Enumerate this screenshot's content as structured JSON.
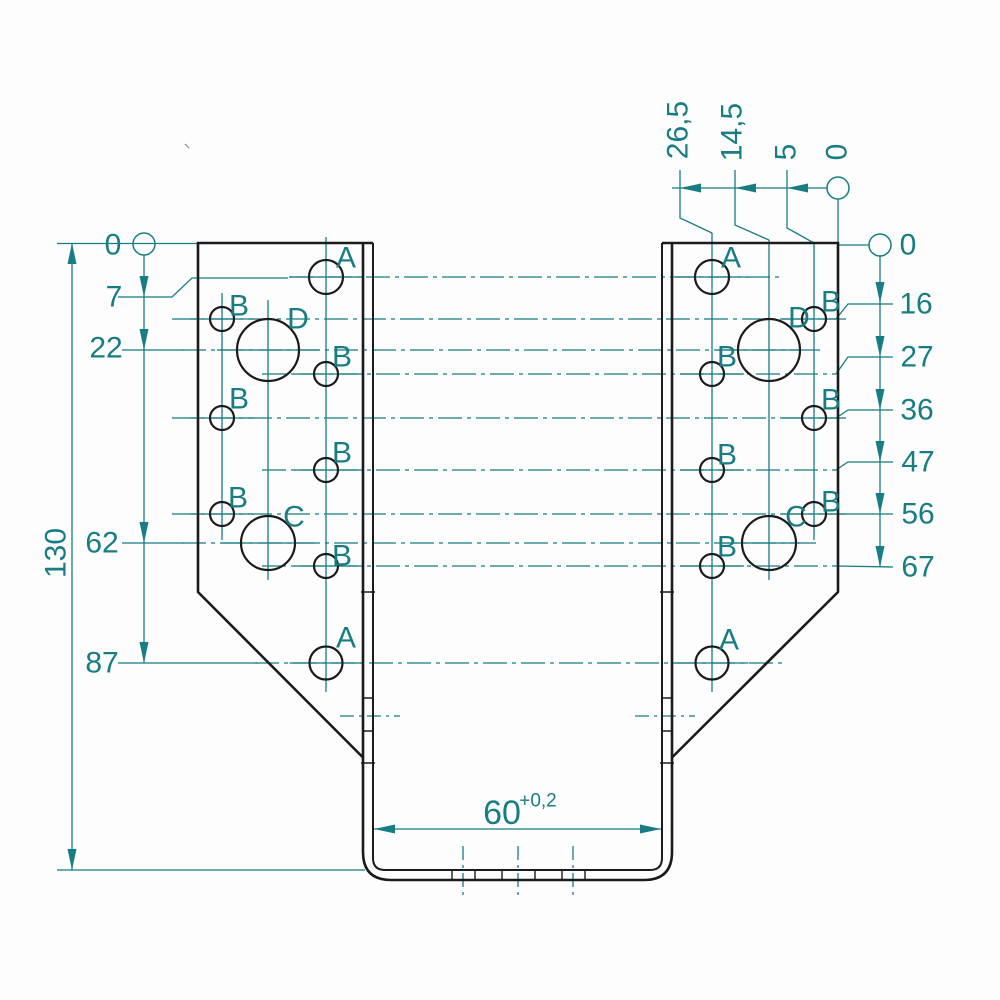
{
  "dimension_values": {
    "left_chain_mm": [
      "0",
      "7",
      "22",
      "62",
      "87"
    ],
    "overall_height_mm": "130",
    "right_chain_mm": [
      "0",
      "16",
      "27",
      "36",
      "47",
      "56",
      "67"
    ],
    "top_chain_mm": [
      "26,5",
      "14,5",
      "5",
      "0"
    ],
    "bottom_width_mm": "60",
    "bottom_width_tolerance": "+0,2",
    "hole_types": [
      "A",
      "B",
      "C",
      "D"
    ]
  },
  "drawing": {
    "colors": {
      "line": "#1b1b1b",
      "dim": "#177d83",
      "bg": "#fdfdfd"
    },
    "dashes": {
      "dd": "24,5,4,5",
      "dds": "14,5,3,5"
    },
    "black_paths": [
      {
        "name": "left-plate-outline",
        "d": "M 373,243 L 198,243 L 198,592 L 363.5,758",
        "w": 2.6
      },
      {
        "name": "right-plate-outline",
        "d": "M 662,243 L 838,243 L 838,592 L 671.5,758",
        "w": 2.6
      },
      {
        "name": "channel-outer-outline",
        "d": "M 363,243 L 363,852 Q 363,880 391,880 L 644,880 Q 672,880 672,852 L 672,243",
        "w": 2.6
      },
      {
        "name": "channel-inner-outline",
        "d": "M 373,243 L 373,858 Q 373,870 385,870 L 650,870 Q 662,870 662,858 L 662,243",
        "w": 2.0
      }
    ],
    "holes": [
      {
        "type": "A",
        "x": 326,
        "y": 277,
        "r": 17
      },
      {
        "type": "B",
        "x": 222,
        "y": 319,
        "r": 12
      },
      {
        "type": "D",
        "x": 268,
        "y": 350,
        "r": 31
      },
      {
        "type": "B",
        "x": 326,
        "y": 374,
        "r": 12
      },
      {
        "type": "B",
        "x": 222,
        "y": 418,
        "r": 12
      },
      {
        "type": "B",
        "x": 326,
        "y": 470,
        "r": 12
      },
      {
        "type": "B",
        "x": 222,
        "y": 514,
        "r": 12
      },
      {
        "type": "C",
        "x": 268,
        "y": 543,
        "r": 27
      },
      {
        "type": "B",
        "x": 326,
        "y": 566,
        "r": 12
      },
      {
        "type": "A",
        "x": 326,
        "y": 663,
        "r": 16.5
      },
      {
        "type": "A",
        "x": 712,
        "y": 277,
        "r": 17
      },
      {
        "type": "B",
        "x": 814,
        "y": 319,
        "r": 12
      },
      {
        "type": "D",
        "x": 769,
        "y": 350,
        "r": 31
      },
      {
        "type": "B",
        "x": 712,
        "y": 374,
        "r": 12
      },
      {
        "type": "B",
        "x": 814,
        "y": 418,
        "r": 12
      },
      {
        "type": "B",
        "x": 712,
        "y": 470,
        "r": 12
      },
      {
        "type": "B",
        "x": 814,
        "y": 514,
        "r": 12
      },
      {
        "type": "C",
        "x": 769,
        "y": 543,
        "r": 27
      },
      {
        "type": "B",
        "x": 712,
        "y": 566,
        "r": 12
      },
      {
        "type": "A",
        "x": 712,
        "y": 663,
        "r": 16.5
      }
    ],
    "black_ticks": [
      {
        "name": "fold-tick",
        "x1": 361,
        "y1": 592,
        "x2": 375,
        "y2": 592
      },
      {
        "name": "fold-tick",
        "x1": 660,
        "y1": 592,
        "x2": 674,
        "y2": 592
      },
      {
        "name": "fold-tick",
        "x1": 361,
        "y1": 763,
        "x2": 375,
        "y2": 763
      },
      {
        "name": "fold-tick",
        "x1": 660,
        "y1": 763,
        "x2": 674,
        "y2": 763
      },
      {
        "name": "fold-tick",
        "x1": 362,
        "y1": 698,
        "x2": 374,
        "y2": 698
      },
      {
        "name": "fold-tick",
        "x1": 661,
        "y1": 698,
        "x2": 673,
        "y2": 698
      },
      {
        "name": "fold-tick",
        "x1": 362,
        "y1": 731,
        "x2": 374,
        "y2": 731
      },
      {
        "name": "fold-tick",
        "x1": 661,
        "y1": 731,
        "x2": 673,
        "y2": 731
      },
      {
        "name": "slot-tick",
        "x1": 452,
        "y1": 870,
        "x2": 452,
        "y2": 880,
        "w": 1.4
      },
      {
        "name": "slot-tick",
        "x1": 475,
        "y1": 870,
        "x2": 475,
        "y2": 880,
        "w": 1.4
      },
      {
        "name": "slot-tick",
        "x1": 502,
        "y1": 870,
        "x2": 502,
        "y2": 880,
        "w": 1.4
      },
      {
        "name": "slot-tick",
        "x1": 535,
        "y1": 870,
        "x2": 535,
        "y2": 880,
        "w": 1.4
      },
      {
        "name": "slot-tick",
        "x1": 562,
        "y1": 870,
        "x2": 562,
        "y2": 880,
        "w": 1.4
      },
      {
        "name": "slot-tick",
        "x1": 585,
        "y1": 870,
        "x2": 585,
        "y2": 880,
        "w": 1.4
      },
      {
        "name": "paper-speck",
        "x1": 185,
        "y1": 144,
        "x2": 189,
        "y2": 148,
        "w": 1.2,
        "c": "#8a8a8a"
      }
    ],
    "teal_lines": [
      {
        "name": "ext-line-top-left",
        "x1": 57,
        "y1": 243.5,
        "x2": 198,
        "y2": 243.5
      },
      {
        "name": "ext-line-bottom-left",
        "x1": 57,
        "y1": 870,
        "x2": 365,
        "y2": 870
      },
      {
        "name": "dim-130-line",
        "x1": 72,
        "y1": 243,
        "x2": 72,
        "y2": 870
      },
      {
        "name": "dim-left-chain-line",
        "x1": 144,
        "y1": 255,
        "x2": 144,
        "y2": 663
      },
      {
        "name": "dim-right-chain-line",
        "x1": 880,
        "y1": 256,
        "x2": 880,
        "y2": 567
      },
      {
        "name": "dim-top-chain-line",
        "x1": 672,
        "y1": 188,
        "x2": 827,
        "y2": 188
      },
      {
        "name": "ext-line-right-0",
        "x1": 839,
        "y1": 245,
        "x2": 869,
        "y2": 245
      },
      {
        "name": "dim-60-line",
        "x1": 374,
        "y1": 829,
        "x2": 661,
        "y2": 829
      },
      {
        "name": "leader-22",
        "x1": 122,
        "y1": 350,
        "x2": 184,
        "y2": 350
      },
      {
        "name": "leader-62",
        "x1": 122,
        "y1": 543,
        "x2": 184,
        "y2": 543
      },
      {
        "name": "leader-87",
        "x1": 118,
        "y1": 663,
        "x2": 258,
        "y2": 663
      },
      {
        "name": "leader-56",
        "x1": 836,
        "y1": 514,
        "x2": 893,
        "y2": 514
      },
      {
        "name": "leader-67",
        "x1": 836,
        "y1": 566,
        "x2": 893,
        "y2": 567
      },
      {
        "name": "column-centerline",
        "x1": 222,
        "y1": 293,
        "x2": 222,
        "y2": 540
      },
      {
        "name": "column-centerline",
        "x1": 268,
        "y1": 300,
        "x2": 268,
        "y2": 580
      },
      {
        "name": "column-centerline",
        "x1": 326,
        "y1": 237,
        "x2": 326,
        "y2": 692
      },
      {
        "name": "column-centerline",
        "x1": 712,
        "y1": 233,
        "x2": 712,
        "y2": 692
      },
      {
        "name": "column-centerline",
        "x1": 769,
        "y1": 240,
        "x2": 769,
        "y2": 580
      },
      {
        "name": "column-centerline",
        "x1": 814,
        "y1": 243,
        "x2": 814,
        "y2": 540
      },
      {
        "name": "row-centerline",
        "x1": 290,
        "y1": 277,
        "x2": 783,
        "y2": 277,
        "dash": "dd"
      },
      {
        "name": "row-centerline",
        "x1": 172,
        "y1": 319,
        "x2": 836,
        "y2": 319,
        "dash": "dd"
      },
      {
        "name": "row-centerline",
        "x1": 182,
        "y1": 350,
        "x2": 800,
        "y2": 350,
        "dash": "dd"
      },
      {
        "name": "row-centerline",
        "x1": 262,
        "y1": 374,
        "x2": 836,
        "y2": 374,
        "dash": "dd"
      },
      {
        "name": "row-centerline",
        "x1": 172,
        "y1": 418,
        "x2": 836,
        "y2": 418,
        "dash": "dd"
      },
      {
        "name": "row-centerline",
        "x1": 262,
        "y1": 470,
        "x2": 836,
        "y2": 470,
        "dash": "dd"
      },
      {
        "name": "row-centerline",
        "x1": 172,
        "y1": 514,
        "x2": 836,
        "y2": 514,
        "dash": "dd"
      },
      {
        "name": "row-centerline",
        "x1": 182,
        "y1": 543,
        "x2": 800,
        "y2": 543,
        "dash": "dd"
      },
      {
        "name": "row-centerline",
        "x1": 262,
        "y1": 566,
        "x2": 836,
        "y2": 566,
        "dash": "dd"
      },
      {
        "name": "row-centerline",
        "x1": 255,
        "y1": 663,
        "x2": 783,
        "y2": 663,
        "dash": "dd"
      },
      {
        "name": "bend-centerline",
        "x1": 340,
        "y1": 716,
        "x2": 400,
        "y2": 716,
        "dash": "dds"
      },
      {
        "name": "bend-centerline",
        "x1": 635,
        "y1": 716,
        "x2": 695,
        "y2": 716,
        "dash": "dds"
      },
      {
        "name": "bottom-centerline",
        "x1": 463,
        "y1": 846,
        "x2": 463,
        "y2": 897,
        "dash": "dds"
      },
      {
        "name": "bottom-centerline",
        "x1": 518,
        "y1": 846,
        "x2": 518,
        "y2": 897,
        "dash": "dds"
      },
      {
        "name": "bottom-centerline",
        "x1": 573,
        "y1": 846,
        "x2": 573,
        "y2": 897,
        "dash": "dds"
      }
    ],
    "teal_polylines": [
      {
        "name": "leader-7",
        "pts": "118,297 172,297 192,278 288,278"
      },
      {
        "name": "leader-16",
        "pts": "836,319 848,304 893,304"
      },
      {
        "name": "leader-27",
        "pts": "836,374 848,357 893,357"
      },
      {
        "name": "leader-36",
        "pts": "836,418 848,410 893,410"
      },
      {
        "name": "leader-47",
        "pts": "836,470 848,462 893,462"
      },
      {
        "name": "leader-top-26-5",
        "pts": "680,170 680,218 712,233"
      },
      {
        "name": "leader-top-14-5",
        "pts": "735,170 735,225 769,240"
      },
      {
        "name": "leader-top-5",
        "pts": "787,170 787,228 814,243"
      },
      {
        "name": "leader-top-0",
        "pts": "838,199 838,243"
      }
    ],
    "datum_circles": [
      {
        "name": "datum-circle-left",
        "cx": 144,
        "cy": 244,
        "r": 11
      },
      {
        "name": "datum-circle-right",
        "cx": 880,
        "cy": 245,
        "r": 11
      },
      {
        "name": "datum-circle-top",
        "cx": 838,
        "cy": 188,
        "r": 11
      }
    ],
    "arrows": [
      {
        "name": "arrow-130-top",
        "dir": "up",
        "x": 72,
        "y": 243
      },
      {
        "name": "arrow-130-bottom",
        "dir": "down",
        "x": 72,
        "y": 870
      },
      {
        "name": "arrow-left-7",
        "dir": "down",
        "x": 144,
        "y": 297
      },
      {
        "name": "arrow-left-22",
        "dir": "down",
        "x": 144,
        "y": 350
      },
      {
        "name": "arrow-left-62",
        "dir": "down",
        "x": 144,
        "y": 543
      },
      {
        "name": "arrow-left-87",
        "dir": "down",
        "x": 144,
        "y": 663
      },
      {
        "name": "arrow-right-16",
        "dir": "down",
        "x": 880,
        "y": 303
      },
      {
        "name": "arrow-right-27",
        "dir": "down",
        "x": 880,
        "y": 357
      },
      {
        "name": "arrow-right-36",
        "dir": "down",
        "x": 880,
        "y": 410
      },
      {
        "name": "arrow-right-47",
        "dir": "down",
        "x": 880,
        "y": 462
      },
      {
        "name": "arrow-right-56",
        "dir": "down",
        "x": 880,
        "y": 514
      },
      {
        "name": "arrow-right-67",
        "dir": "down",
        "x": 880,
        "y": 567
      },
      {
        "name": "arrow-top-26-5",
        "dir": "left",
        "x": 680,
        "y": 188
      },
      {
        "name": "arrow-top-14-5",
        "dir": "left",
        "x": 735,
        "y": 188
      },
      {
        "name": "arrow-top-5",
        "dir": "left",
        "x": 787,
        "y": 188
      },
      {
        "name": "arrow-60-left",
        "dir": "left",
        "x": 374,
        "y": 829
      },
      {
        "name": "arrow-60-right",
        "dir": "right",
        "x": 661,
        "y": 829
      }
    ],
    "texts": [
      {
        "name": "dim-label-left-0",
        "text": "0",
        "x": 113,
        "y": 245
      },
      {
        "name": "dim-label-left-7",
        "text": "7",
        "x": 114,
        "y": 297
      },
      {
        "name": "dim-label-left-22",
        "text": "22",
        "x": 106,
        "y": 348
      },
      {
        "name": "dim-label-left-62",
        "text": "62",
        "x": 102,
        "y": 543
      },
      {
        "name": "dim-label-left-87",
        "text": "87",
        "x": 102,
        "y": 663
      },
      {
        "name": "dim-label-height-130",
        "text": "130",
        "x": 56,
        "y": 553,
        "rot": -90
      },
      {
        "name": "dim-label-right-0",
        "text": "0",
        "x": 908,
        "y": 245
      },
      {
        "name": "dim-label-right-16",
        "text": "16",
        "x": 916,
        "y": 304
      },
      {
        "name": "dim-label-right-27",
        "text": "27",
        "x": 917,
        "y": 357
      },
      {
        "name": "dim-label-right-36",
        "text": "36",
        "x": 917,
        "y": 410
      },
      {
        "name": "dim-label-right-47",
        "text": "47",
        "x": 918,
        "y": 462
      },
      {
        "name": "dim-label-right-56",
        "text": "56",
        "x": 918,
        "y": 514
      },
      {
        "name": "dim-label-right-67",
        "text": "67",
        "x": 918,
        "y": 567
      },
      {
        "name": "dim-label-top-26-5",
        "text": "26,5",
        "x": 678,
        "y": 130,
        "rot": -90
      },
      {
        "name": "dim-label-top-14-5",
        "text": "14,5",
        "x": 732,
        "y": 132,
        "rot": -90
      },
      {
        "name": "dim-label-top-5",
        "text": "5",
        "x": 786,
        "y": 152,
        "rot": -90
      },
      {
        "name": "dim-label-top-0",
        "text": "0",
        "x": 837,
        "y": 152,
        "rot": -90
      },
      {
        "name": "dim-label-width-60",
        "text": "60",
        "x": 502,
        "y": 813,
        "size": 34
      },
      {
        "name": "dim-label-width-tol",
        "text": "+0,2",
        "x": 538,
        "y": 801,
        "size": 19
      },
      {
        "name": "hole-label-a",
        "text": "A",
        "x": 346,
        "y": 258
      },
      {
        "name": "hole-label-b",
        "text": "B",
        "x": 239,
        "y": 306
      },
      {
        "name": "hole-label-d",
        "text": "D",
        "x": 298,
        "y": 319
      },
      {
        "name": "hole-label-b",
        "text": "B",
        "x": 342,
        "y": 357
      },
      {
        "name": "hole-label-b",
        "text": "B",
        "x": 239,
        "y": 399
      },
      {
        "name": "hole-label-b",
        "text": "B",
        "x": 342,
        "y": 453
      },
      {
        "name": "hole-label-b",
        "text": "B",
        "x": 238,
        "y": 498
      },
      {
        "name": "hole-label-c",
        "text": "C",
        "x": 294,
        "y": 517
      },
      {
        "name": "hole-label-b",
        "text": "B",
        "x": 342,
        "y": 556
      },
      {
        "name": "hole-label-a",
        "text": "A",
        "x": 346,
        "y": 638
      },
      {
        "name": "hole-label-a",
        "text": "A",
        "x": 731,
        "y": 258
      },
      {
        "name": "hole-label-b",
        "text": "B",
        "x": 831,
        "y": 302
      },
      {
        "name": "hole-label-d",
        "text": "D",
        "x": 799,
        "y": 318
      },
      {
        "name": "hole-label-b",
        "text": "B",
        "x": 727,
        "y": 357
      },
      {
        "name": "hole-label-b",
        "text": "B",
        "x": 831,
        "y": 400
      },
      {
        "name": "hole-label-b",
        "text": "B",
        "x": 727,
        "y": 455
      },
      {
        "name": "hole-label-b",
        "text": "B",
        "x": 831,
        "y": 502
      },
      {
        "name": "hole-label-c",
        "text": "C",
        "x": 796,
        "y": 517
      },
      {
        "name": "hole-label-b",
        "text": "B",
        "x": 727,
        "y": 547
      },
      {
        "name": "hole-label-a",
        "text": "A",
        "x": 729,
        "y": 640
      }
    ]
  }
}
